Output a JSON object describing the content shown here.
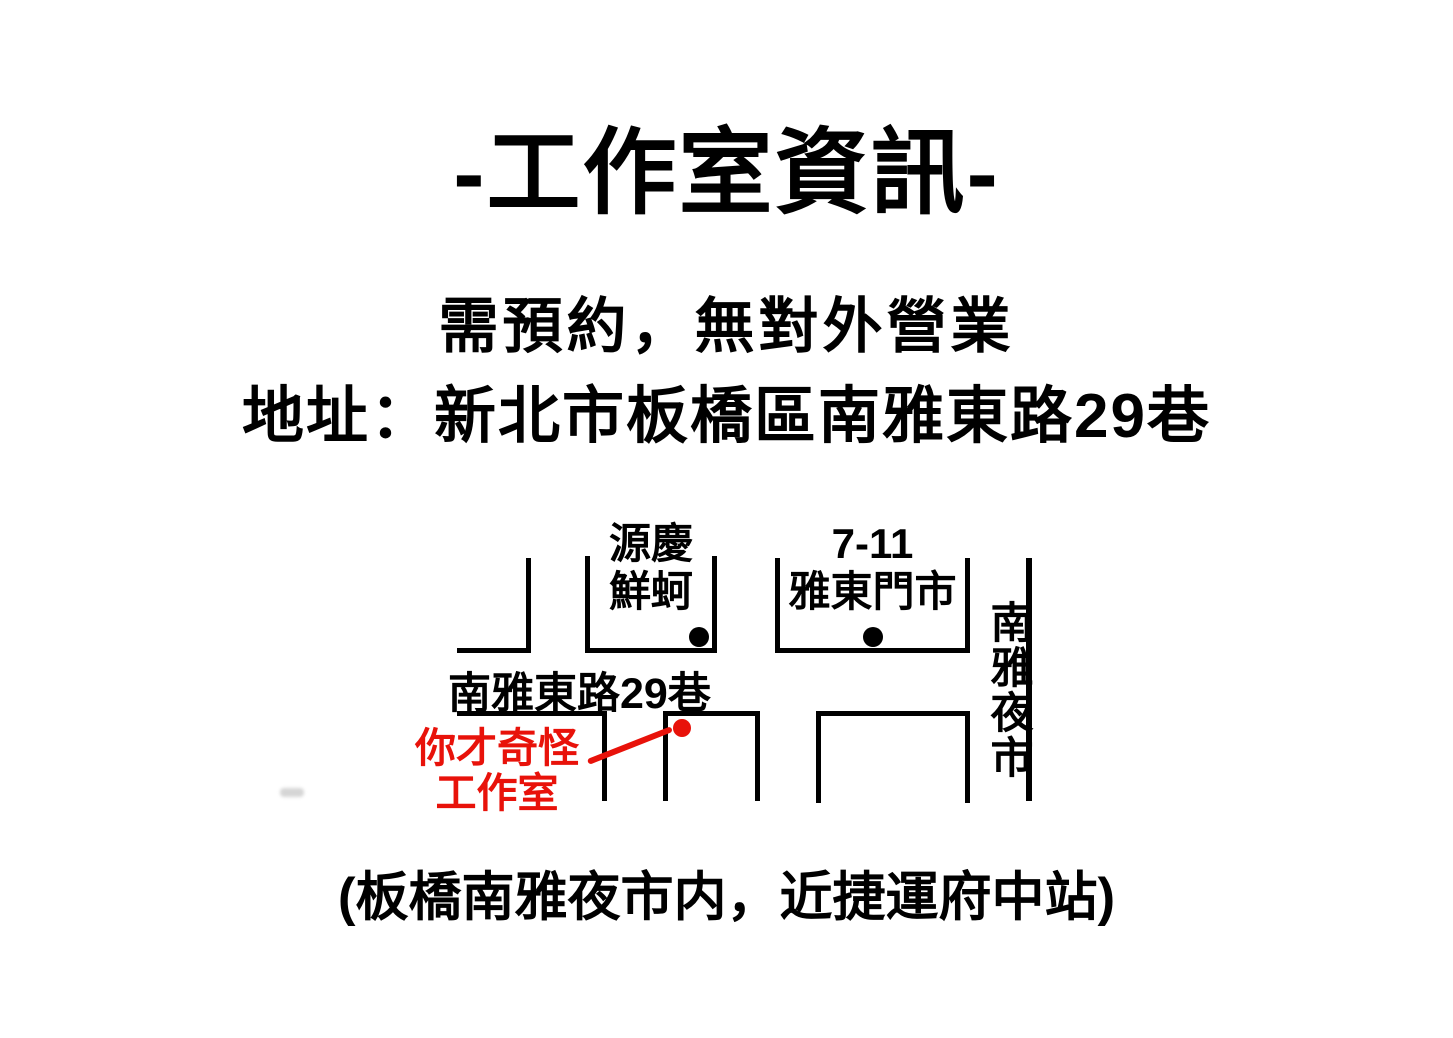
{
  "flyer": {
    "title": "-工作室資訊-",
    "notice": "需預約，無對外營業",
    "address": "地址：新北市板橋區南雅東路29巷",
    "footer": "(板橋南雅夜市内，近捷運府中站)"
  },
  "map": {
    "street": "南雅東路29巷",
    "night_market": "南雅夜市",
    "pois": {
      "oyster_shop": {
        "line1": "源慶",
        "line2": "鮮蚵"
      },
      "seven_eleven": {
        "line1": "7-11",
        "line2": "雅東門市"
      },
      "studio": {
        "line1": "你才奇怪",
        "line2": "工作室"
      }
    },
    "colors": {
      "outline": "#000000",
      "poi_marker": "#000000",
      "studio_red": "#e8120a"
    }
  }
}
